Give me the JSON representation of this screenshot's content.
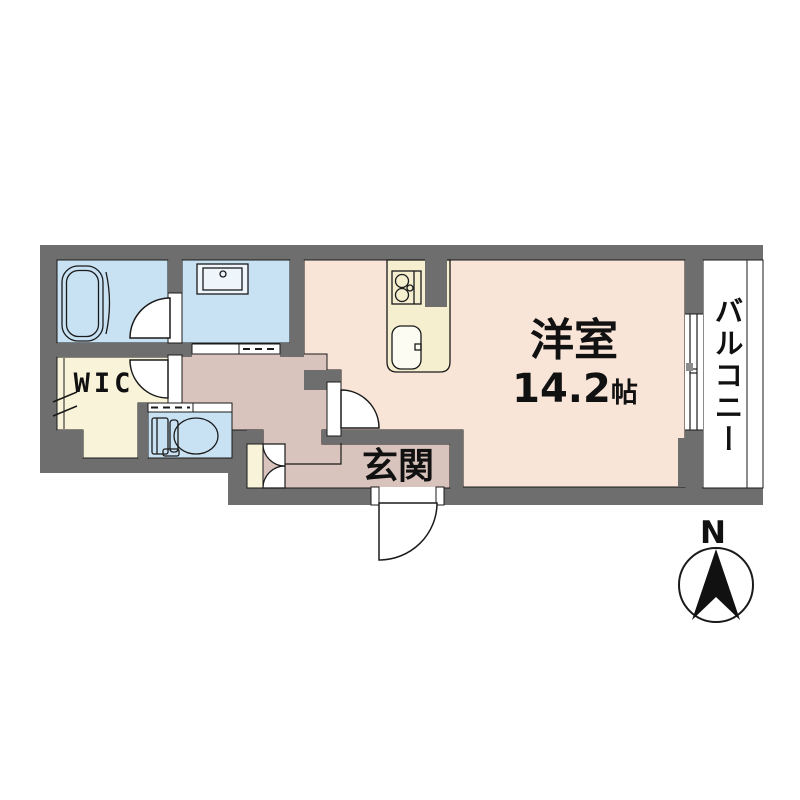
{
  "floorplan": {
    "rooms": {
      "living": {
        "label": "洋室",
        "size_value": "14.2",
        "size_unit": "帖"
      },
      "entrance": {
        "label": "玄関"
      },
      "walk_in_closet": {
        "label": "WIC"
      },
      "balcony": {
        "label": "バルコニー"
      }
    },
    "compass": {
      "north_label": "N"
    },
    "colors": {
      "wall": "#6e6e6e",
      "wet_area_blue": "#c8e2f3",
      "room_peach": "#f9e5d8",
      "hall_mauve": "#d8c3bd",
      "closet_cream": "#f8f3d9",
      "counter_cream": "#f5efd0",
      "outline_black": "#1a1a1a",
      "background": "#ffffff"
    }
  }
}
